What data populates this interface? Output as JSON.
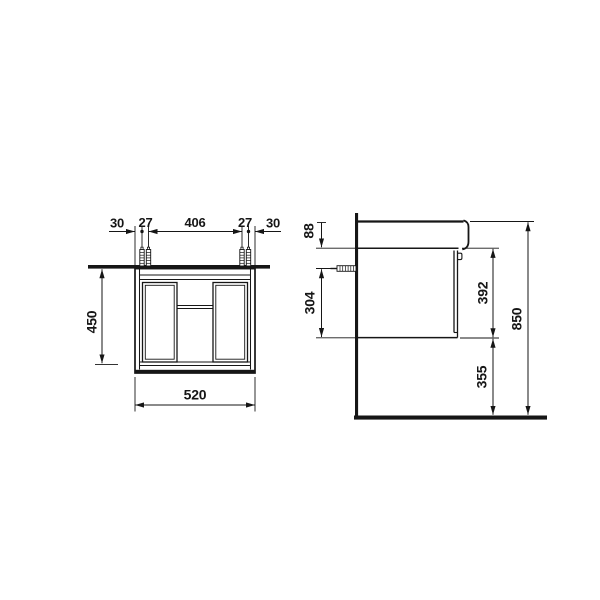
{
  "drawing_title": "vanity-unit-technical-drawing",
  "dims": {
    "front": {
      "offset_left": "30",
      "screw_left": "27",
      "span": "406",
      "screw_right": "27",
      "offset_right": "30",
      "height": "450",
      "width": "520"
    },
    "side": {
      "basin": "88",
      "screw": "304",
      "cabinet": "392",
      "floor_gap": "355",
      "total": "850"
    }
  },
  "colors": {
    "line": "#161616",
    "background": "#ffffff"
  }
}
